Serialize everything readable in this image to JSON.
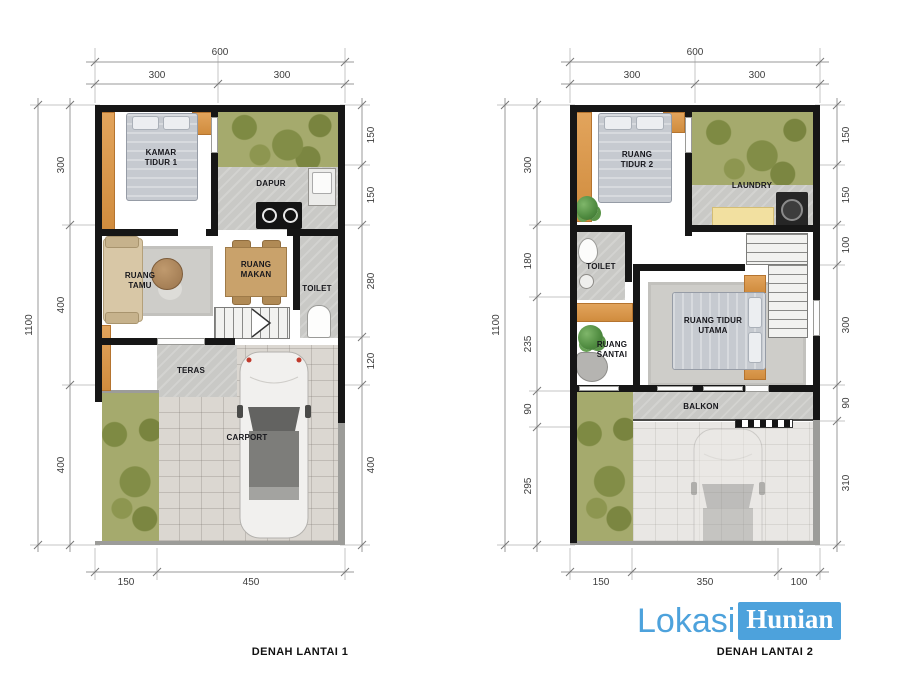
{
  "logo": {
    "part1": "Lokasi",
    "part2": "Hunian",
    "blue": "#4DA2DC"
  },
  "colors": {
    "wall": "#161616",
    "wood_orange": "#DD9A4E",
    "garden_green": "#A5AA6D",
    "floor_gray": "#C9C9C6"
  },
  "plans": [
    {
      "title": "DENAH LANTAI 1",
      "dims": {
        "top_total": "600",
        "top": [
          "300",
          "300"
        ],
        "side_total": "1100",
        "left": [
          "300",
          "400",
          "400"
        ],
        "right": [
          "150",
          "150",
          "280",
          "120",
          "400"
        ],
        "bottom": [
          "150",
          "450"
        ]
      },
      "rooms": {
        "bedroom": "KAMAR TIDUR 1",
        "kitchen": "DAPUR",
        "living": "RUANG TAMU",
        "dining": "RUANG MAKAN",
        "toilet": "TOILET",
        "porch": "TERAS",
        "carport": "CARPORT"
      }
    },
    {
      "title": "DENAH LANTAI 2",
      "dims": {
        "top_total": "600",
        "top": [
          "300",
          "300"
        ],
        "side_total": "1100",
        "left": [
          "300",
          "180",
          "235",
          "90",
          "295"
        ],
        "right": [
          "150",
          "150",
          "100",
          "300",
          "90",
          "310"
        ],
        "bottom": [
          "150",
          "350",
          "100"
        ]
      },
      "rooms": {
        "bedroom2": "RUANG TIDUR 2",
        "laundry": "LAUNDRY",
        "toilet": "TOILET",
        "lounge": "RUANG SANTAI",
        "master": "RUANG TIDUR UTAMA",
        "balcony": "BALKON"
      }
    }
  ]
}
